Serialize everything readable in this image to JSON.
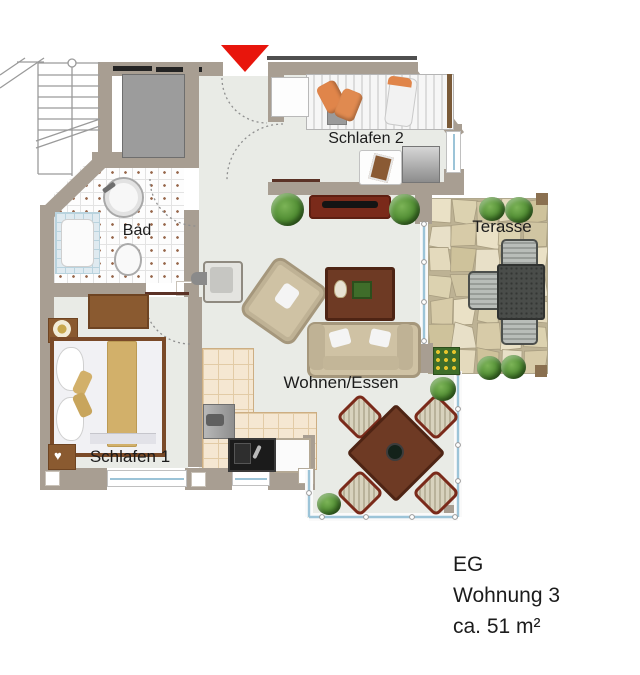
{
  "plan": {
    "title": "floor-plan",
    "rooms": {
      "schlafen2": {
        "label": "Schlafen 2"
      },
      "bad": {
        "label": "Bad"
      },
      "terasse": {
        "label": "Terasse"
      },
      "schlafen1": {
        "label": "Schlafen 1"
      },
      "wohnen_essen": {
        "label": "Wohnen/Essen"
      }
    },
    "info": {
      "floor": "EG",
      "unit": "Wohnung 3",
      "area": "ca. 51 m²"
    },
    "colors": {
      "wall": "#a89e92",
      "floor": "#e9ebe6",
      "entrance_red": "#e8150c",
      "bath_tile": "#fdfdfd",
      "kitchen_tile": "#f5e7d2",
      "terrace_stone": "#ded3b2",
      "dark_wood": "#6e3a24",
      "sideboard_wood": "#7a2a1a",
      "upholstery": "#cfc2a4"
    }
  }
}
